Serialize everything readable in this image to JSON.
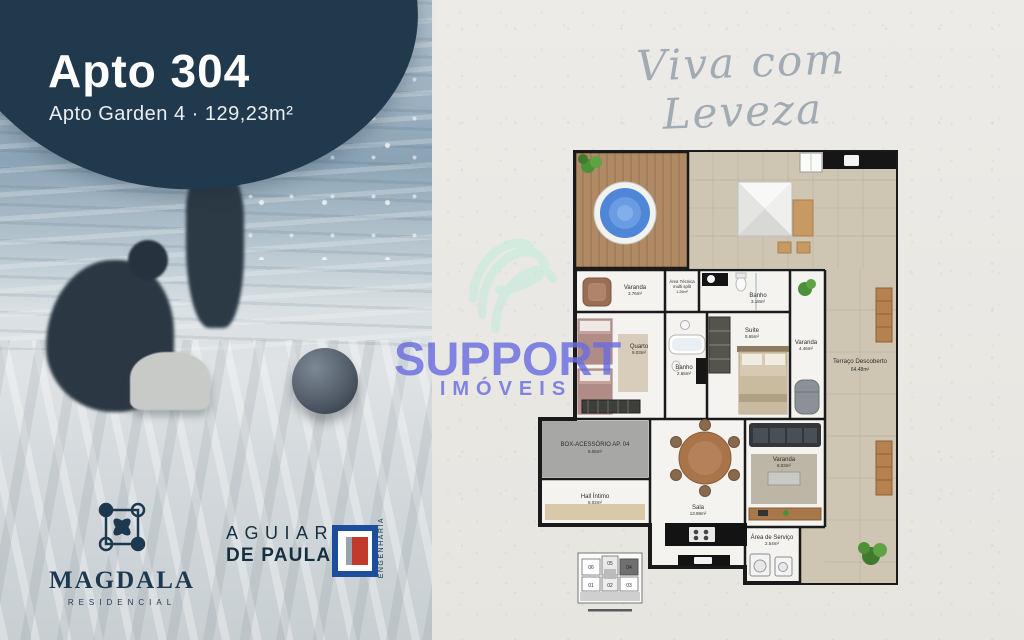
{
  "header": {
    "title": "Apto 304",
    "subtitle": "Apto Garden 4 · 129,23m²"
  },
  "tagline": "Viva com Leveza",
  "watermark": {
    "brand": "SUPPORT",
    "sub": "IMÓVEIS"
  },
  "floor_plan": {
    "rooms": [
      {
        "name": "Varanda",
        "area": "3.76m²"
      },
      {
        "name": "Quarto",
        "area": "9.03m²"
      },
      {
        "name": "Área Técnica",
        "sub": "multi split",
        "area": "1.26m²"
      },
      {
        "name": "Banho",
        "area": "3.18m²"
      },
      {
        "name": "Banho",
        "area": "2.65m²"
      },
      {
        "name": "Suíte",
        "area": "8.65m²"
      },
      {
        "name": "Varanda",
        "area": "4.46m²"
      },
      {
        "name": "Terraço Descoberto",
        "area": "64.48m²"
      },
      {
        "name": "BOX-ACESSÓRIO AP. 04",
        "area": "6.05m²"
      },
      {
        "name": "Hall Íntimo",
        "area": "6.02m²"
      },
      {
        "name": "Sala",
        "area": "13.98m²"
      },
      {
        "name": "Varanda",
        "area": "8.03m²"
      },
      {
        "name": "Área de Serviço",
        "area": "2.54m²"
      }
    ],
    "key_plan": {
      "units": [
        "06",
        "05",
        "04",
        "01",
        "02",
        "03"
      ],
      "highlighted_unit": "04"
    }
  },
  "logos": {
    "magdala": {
      "name": "MAGDALA",
      "tagline": "RESIDENCIAL"
    },
    "aguiar": {
      "line1": "AGUIAR",
      "line2": "DE PAULA",
      "vertical": "ENGENHARIA"
    }
  },
  "colors": {
    "navy": "#21394d",
    "watermark_purple": "#6b6ede",
    "script_gray": "#a2abb3",
    "paper": "#eae8e4",
    "terrace_tile": "#cec5b3",
    "deck_wood": "#b08a64",
    "wall": "#1a1a1a",
    "pool_blue": "#4f86d8",
    "magdala_navy": "#1d3950",
    "aguiar_blue": "#1d4e9b",
    "aguiar_red": "#c23a2c"
  }
}
